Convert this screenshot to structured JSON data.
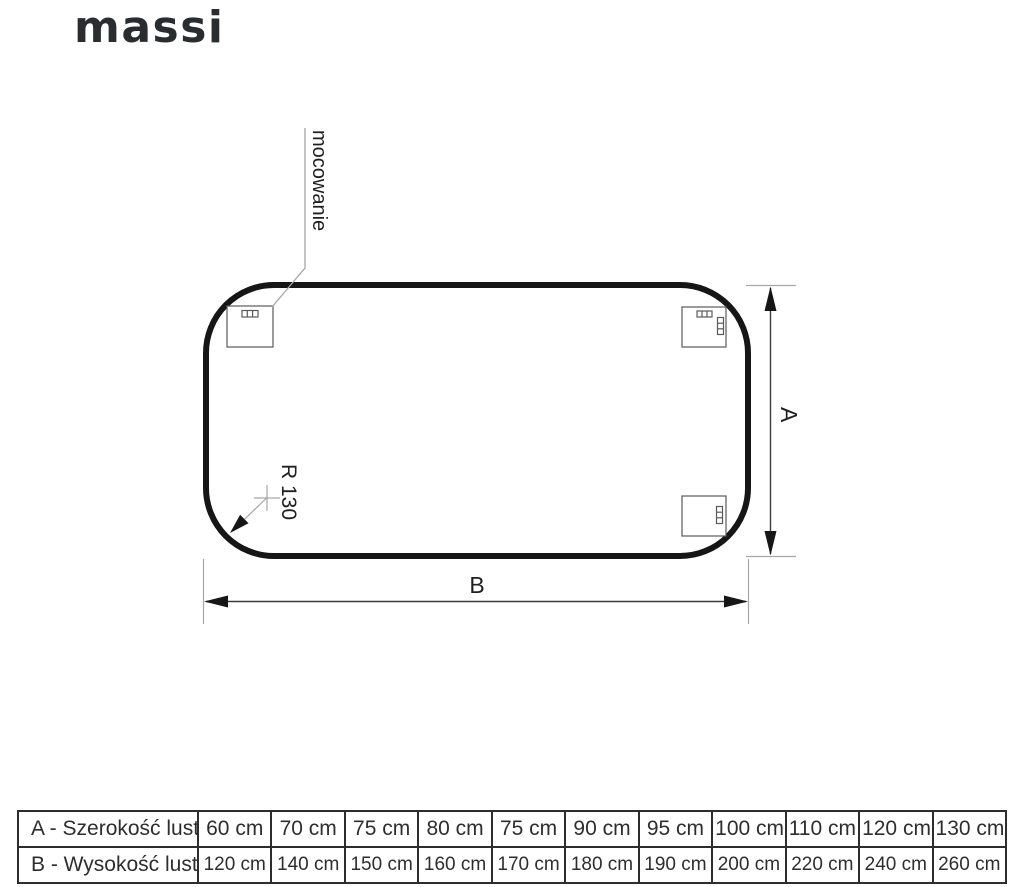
{
  "brand": {
    "logo_text": "massi"
  },
  "diagram": {
    "mount_label": "mocowanie",
    "radius_label": "R 130",
    "height_dim_label": "A",
    "width_dim_label": "B"
  },
  "size_table": {
    "rows": [
      {
        "header": "A - Szerokość lustra",
        "values": [
          "60 cm",
          "70 cm",
          "75 cm",
          "80 cm",
          "75 cm",
          "90 cm",
          "95 cm",
          "100 cm",
          "110 cm",
          "120 cm",
          "130 cm"
        ]
      },
      {
        "header": "B - Wysokość lustra",
        "values": [
          "120 cm",
          "140 cm",
          "150 cm",
          "160 cm",
          "170 cm",
          "180 cm",
          "190 cm",
          "200 cm",
          "220 cm",
          "240 cm",
          "260 cm"
        ]
      }
    ]
  },
  "colors": {
    "line_dark": "#161616",
    "line_gray": "#a6a6a6",
    "text": "#2e2e2e",
    "background": "#ffffff"
  }
}
